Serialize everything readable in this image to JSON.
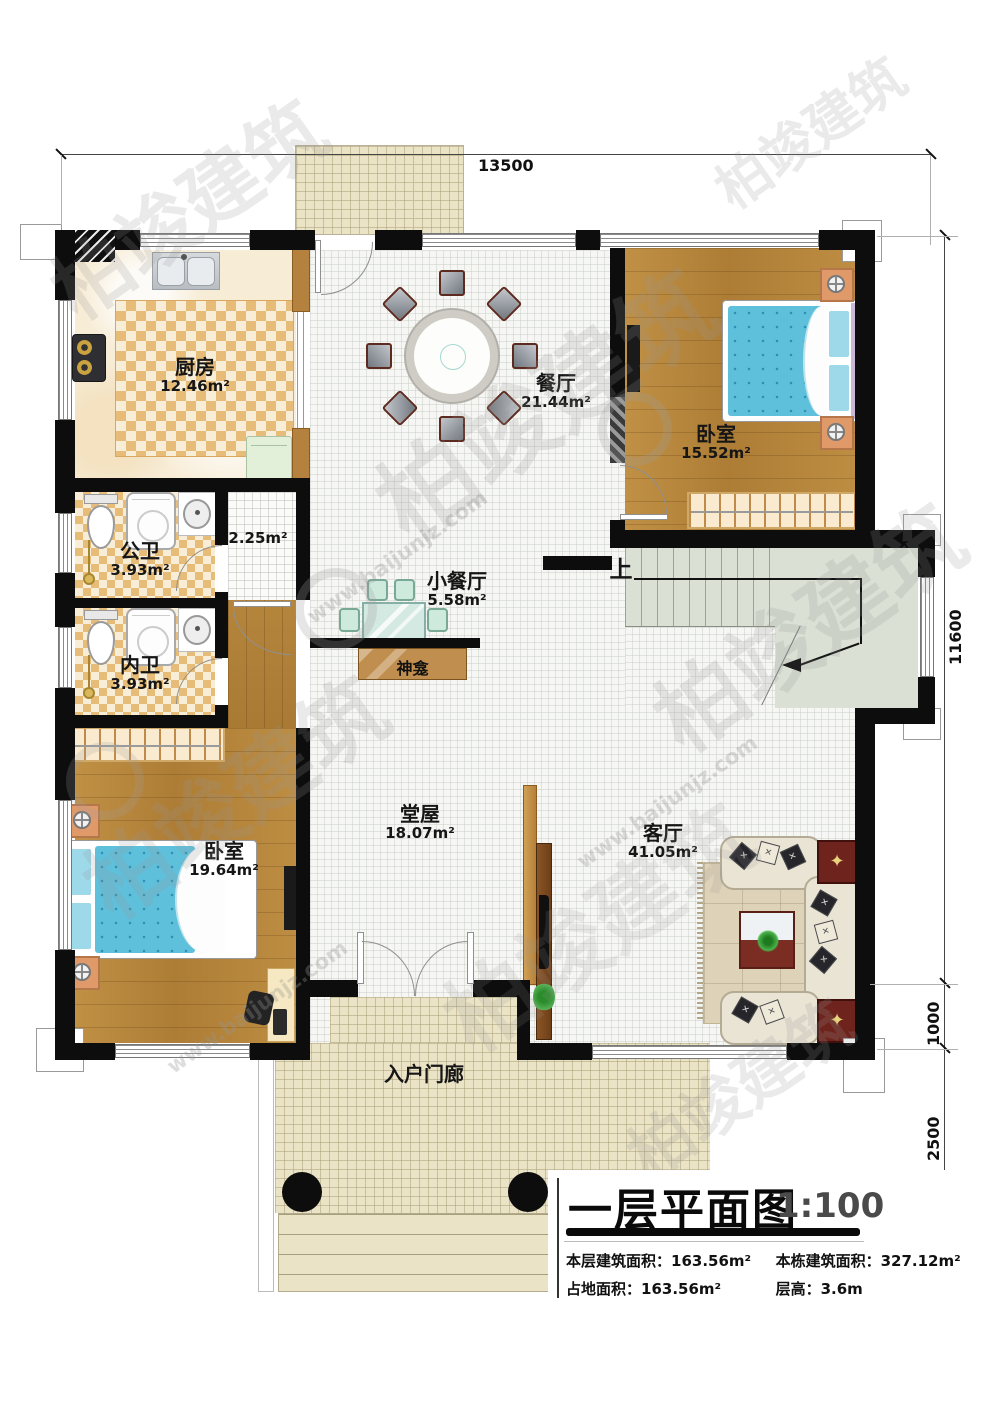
{
  "dimensions": {
    "top": "13500",
    "right_upper": "11600",
    "right_mid": "1000",
    "right_lower": "2500"
  },
  "rooms": {
    "kitchen": {
      "name": "厨房",
      "area": "12.46m²"
    },
    "dining": {
      "name": "餐厅",
      "area": "21.44m²"
    },
    "bedroom_top_right": {
      "name": "卧室",
      "area": "15.52m²"
    },
    "public_bath": {
      "name": "公卫",
      "area": "3.93m²"
    },
    "inner_bath": {
      "name": "内卫",
      "area": "3.93m²"
    },
    "corridor": {
      "area": "2.25m²"
    },
    "small_dining": {
      "name": "小餐厅",
      "area": "5.58m²"
    },
    "shrine": {
      "name": "神龛"
    },
    "hall": {
      "name": "堂屋",
      "area": "18.07m²"
    },
    "living": {
      "name": "客厅",
      "area": "41.05m²"
    },
    "bedroom_bottom_left": {
      "name": "卧室",
      "area": "19.64m²"
    },
    "entry_porch": {
      "name": "入户门廊"
    },
    "stairs": {
      "up_label": "上"
    }
  },
  "title_block": {
    "title": "一层平面图",
    "scale": "1:100",
    "stats": [
      {
        "label": "本层建筑面积：",
        "value": "163.56m²"
      },
      {
        "label": "本栋建筑面积：",
        "value": "327.12m²"
      },
      {
        "label": "占地面积：",
        "value": "163.56m²"
      },
      {
        "label": "层高：",
        "value": "3.6m"
      }
    ]
  },
  "watermark": {
    "brand": "柏竣建筑",
    "url": "www.baijunjz.com"
  },
  "colors": {
    "wall": "#0d0d0d",
    "wood_floor": "#b8873d",
    "checker_dark": "#e7bc78",
    "checker_light": "#f8edd6",
    "bed_blue": "#5fc0dc",
    "stair_floor": "#dae0d4",
    "porch_tile": "#ebe3c6",
    "sofa_cream": "#eae4d4",
    "table_redwood": "#6e241c",
    "shrine_wood": "#c08f4f",
    "teal_table": "#cfe6df",
    "nightstand_copper": "#e09a6a"
  }
}
